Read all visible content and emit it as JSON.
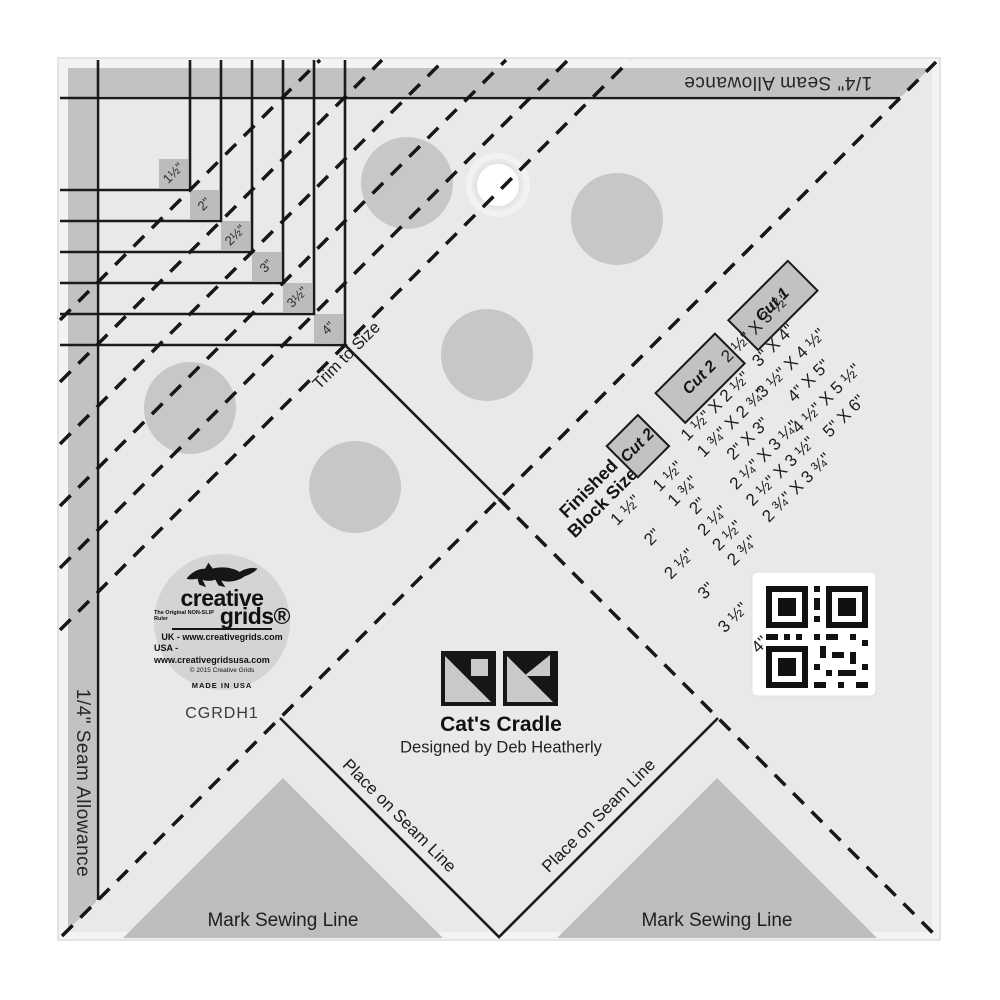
{
  "ruler": {
    "model_number": "CGRDH1",
    "seam_allowance_top": "1/4\" Seam Allowance",
    "seam_allowance_left": "1/4\" Seam Allowance",
    "trim_to_size_label": "Trim to Size",
    "size_labels": [
      "1½\"",
      "2\"",
      "2½\"",
      "3\"",
      "3½\"",
      "4\""
    ],
    "place_on_seam_line_left": "Place on Seam Line",
    "place_on_seam_line_right": "Place on Seam Line",
    "mark_sewing_line_left": "Mark Sewing Line",
    "mark_sewing_line_right": "Mark Sewing Line"
  },
  "block_info": {
    "title": "Cat's Cradle",
    "designer": "Designed by Deb Heatherly"
  },
  "cutting_table": {
    "row_header_line1": "Finished",
    "row_header_line2": "Block Size",
    "col_cut2_square_header": "Cut 2",
    "col_cut2_rect_header": "Cut 2",
    "col_cut1_header": "Cut 1",
    "finished_sizes": [
      "1 ½\"",
      "2\"",
      "2 ½\"",
      "3\"",
      "3 ½\"",
      "4\""
    ],
    "cut2_squares": [
      "1 ½\"",
      "1 ¾\"",
      "2\"",
      "2 ¼\"",
      "2 ½\"",
      "2 ¾\""
    ],
    "cut2_rectangles": [
      "1 ½\" X 2 ½\"",
      "1 ¾\" X 2 ¾\"",
      "2\" X 3\"",
      "2 ¼\" X 3 ¼\"",
      "2 ½\" X 3 ½\"",
      "2 ¾\" X 3 ¾\""
    ],
    "cut1_rectangles": [
      "2 ½\" X 3 ½\"",
      "3\" X 4\"",
      "3 ½\" X 4 ½\"",
      "4\" X 5\"",
      "4 ½\" X 5 ½\"",
      "5\" X 6\""
    ]
  },
  "logo": {
    "brand_line1": "creative",
    "brand_line2": "grids®",
    "tagline": "The Original NON-SLIP Ruler",
    "uk_site": "UK - www.creativegrids.com",
    "usa_site": "USA - www.creativegridsusa.com",
    "copyright": "© 2015 Creative Grids",
    "made_in": "MADE IN USA"
  },
  "colors": {
    "ruler_body": "#e9e9e9",
    "seam_band": "#c2c2c2",
    "grip_dot": "#c7c7c7",
    "triangle": "#bdbdbd",
    "line": "#1b1b1b",
    "logo_bg": "#d4d4d4"
  }
}
